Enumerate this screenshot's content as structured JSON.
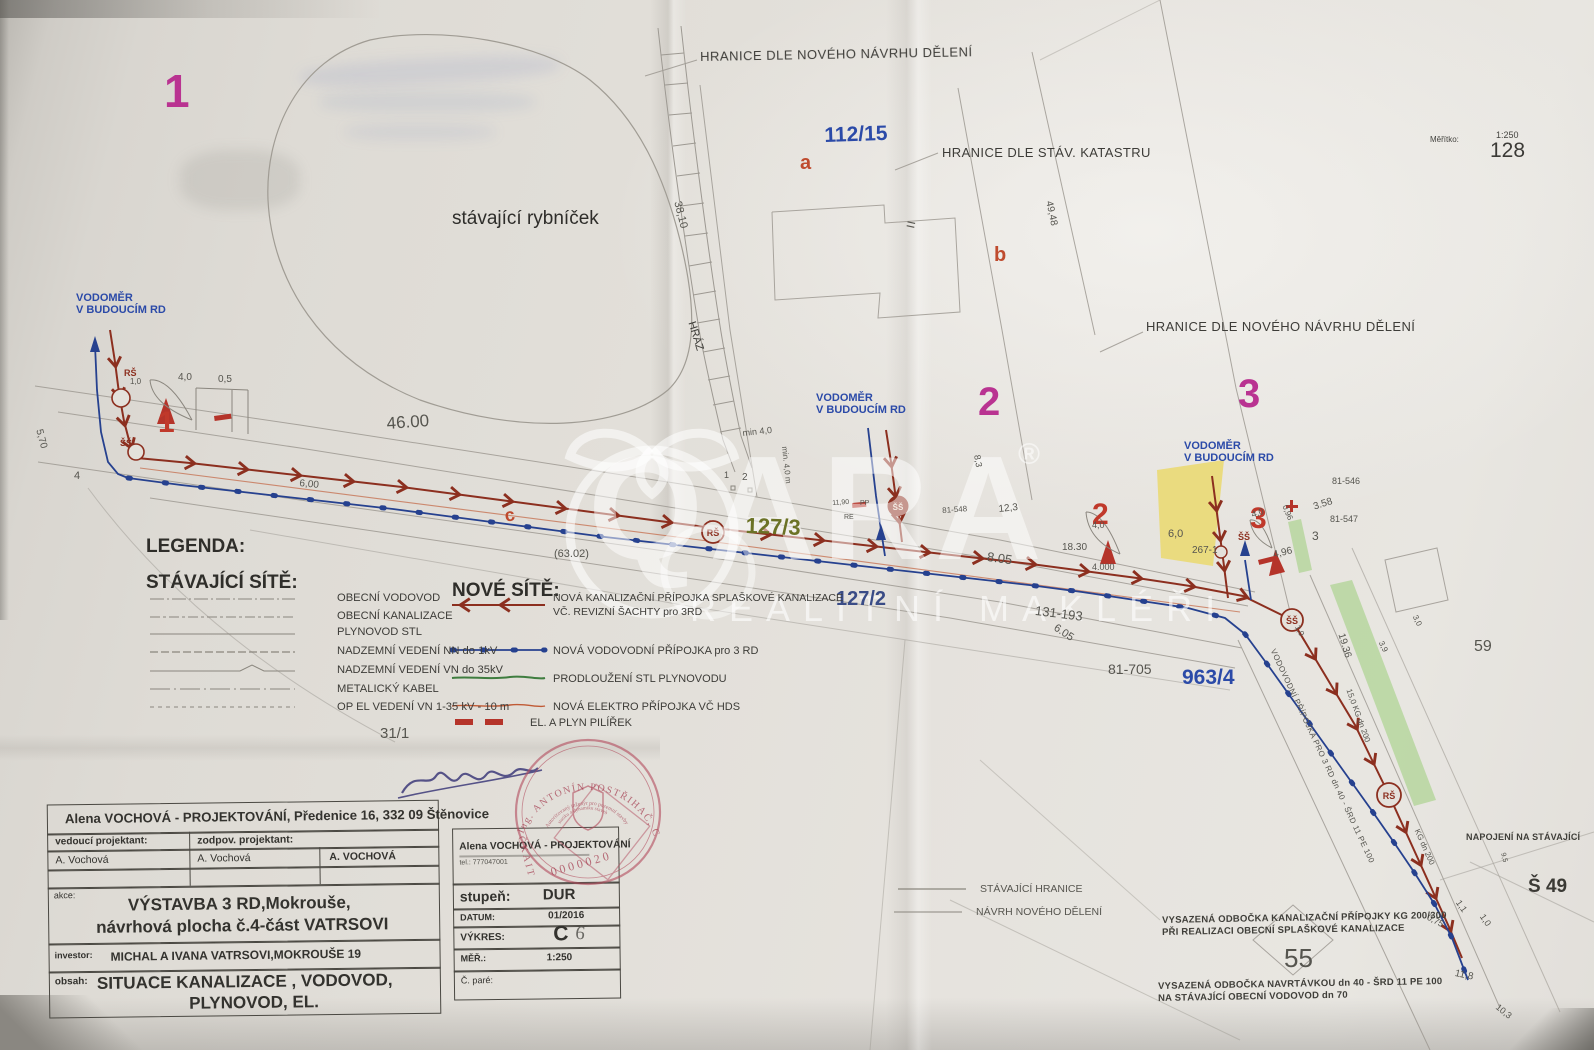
{
  "meta": {
    "scale_label": "Měřítko:",
    "scale_value": "1:250",
    "sheet_number": "128"
  },
  "colors": {
    "kanalizace": "#8c2f1f",
    "vodovod": "#26418f",
    "plynovod": "#4f8a4a",
    "elektro": "#c05a35",
    "magenta": "#b93391",
    "yellow_parcel": "#ead974",
    "stamp_red": "#b24a5c",
    "label_blue": "#2b4aa8"
  },
  "watermark": {
    "brand": "QARA",
    "reg": "®",
    "subtitle": "REALITNÍ MAKLÉŘI"
  },
  "map": {
    "boundary_top": "HRANICE DLE NOVÉHO NÁVRHU DĚLENÍ",
    "boundary_katastr": "HRANICE DLE STÁV. KATASTRU",
    "boundary_right": "HRANICE DLE NOVÉHO NÁVRHU DĚLENÍ",
    "pond": "stávající rybníček",
    "hraz": "HRÁZ",
    "vodomer_line1": "VODOMĚR",
    "vodomer_line2": "V BUDOUCÍM RD",
    "parcel_112": "112/15",
    "parcel_127_3": "127/3",
    "parcel_127_2": "127/2",
    "parcel_963": "963/4",
    "parcel_131": "131-193",
    "parcel_81_705": "81-705",
    "parcel_81_546": "81-546",
    "parcel_81_547": "81-547",
    "parcel_81_548": "81-548",
    "parcel_31": "31/1",
    "parcel_59": "59",
    "parcel_55": "55",
    "parcel_267": "267-1",
    "parcel_s49": "Š 49",
    "plot_mag_1": "1",
    "plot_mag_2": "2",
    "plot_mag_3": "3",
    "plot_red_1": "1",
    "plot_red_2": "2",
    "plot_red_3": "3",
    "letter_a": "a",
    "letter_b": "b",
    "letter_c": "c",
    "equals": "=",
    "shaft_rs": "RŠ",
    "shaft_ss": "ŠŠ",
    "corner_1": "1",
    "corner_2": "2"
  },
  "dims": {
    "d46": "46.00",
    "d570": "5,70",
    "d4": "4",
    "d600": "6,00",
    "d3810": "38,10",
    "d4948": "49,48",
    "d6302": "(63.02)",
    "d805": "8.05",
    "d605": "6.05",
    "dmin40": "min 4,0",
    "dmin40m": "min. 4,0 m",
    "d1190": "11,90",
    "dpp": "PP",
    "dre": "RE",
    "d123": "12,3",
    "d83": "8,3",
    "d1830": "18.30",
    "d40a": "4,0",
    "d4000": "4.000",
    "d60": "6,0",
    "d40b": "4,0",
    "d096": "0,96",
    "d358": "3.58",
    "d3": "3",
    "d496": "4,96",
    "d10a": "1,0",
    "d1936": "19.36",
    "d30": "3,0",
    "d39": "3,9",
    "d075": "0,75",
    "d11": "1,1",
    "d10b": "1,0",
    "d118": "11,8",
    "d103": "10,3",
    "d95": "9,5",
    "d40c": "4,0",
    "d05": "0,5",
    "d10c": "1,0"
  },
  "notes": {
    "napojeni": "NAPOJENÍ NA STÁVAJÍCÍ",
    "vysazena1a": "VYSAZENÁ ODBOČKA  KANALIZAČNÍ PŘÍPOJKY  KG 200/300",
    "vysazena1b": "PŘI REALIZACI OBECNÍ SPLAŠKOVÉ KANALIZACE",
    "vysazena2a": "VYSAZENÁ ODBOČKA  NAVRTÁVKOU dn 40  - ŠRD 11 PE 100",
    "vysazena2b": "NA STÁVAJÍCÍ OBECNÍ VODOVOD  dn 70",
    "vodovodni_diag": "VODOVODNÍ PŘÍPOJKA PRO 3 RD  dn 40 - ŠRD 11 PE 100",
    "kg_15": "15,0  KG dn 200",
    "kg_dn200": "KG dn 200"
  },
  "legend": {
    "title": "LEGENDA:",
    "existing_title": "STÁVAJÍCÍ SÍTĚ:",
    "existing": [
      "OBECNÍ VODOVOD",
      "OBECNÍ KANALIZACE",
      "PLYNOVOD STL",
      "NADZEMNÍ VEDENÍ  NN do 1kV",
      "NADZEMNÍ VEDENÍ  VN do 35kV",
      "METALICKÝ KABEL",
      "OP EL VEDENÍ VN 1-35 kV   - 10 m"
    ],
    "new_title": "NOVÉ SÍTĚ:",
    "new_1": "NOVÁ KANALIZAČNÍ PŘÍPOJKA SPLAŠKOVÉ KANALIZACE\nVČ. REVIZNÍ  ŠACHTY  pro 3RD",
    "new_2": "NOVÁ VODOVODNÍ  PŘÍPOJKA  pro 3 RD",
    "new_3": "PRODLOUŽENÍ  STL  PLYNOVODU",
    "new_4": "NOVÁ ELEKTRO   PŘÍPOJKA VČ  HDS",
    "new_5": "EL. A PLYN PILÍŘEK",
    "boundary_existing": "STÁVAJÍCÍ  HRANICE",
    "boundary_new": "NÁVRH NOVÉHO DĚLENÍ"
  },
  "title_block": {
    "company_header": "Alena VOCHOVÁ - PROJEKTOVÁNÍ, Předenice 16, 332 09 Štěnovice",
    "role1_label": "vedoucí projektant:",
    "role2_label": "zodpov. projektant:",
    "name1": "A. Vochová",
    "name2": "A. Vochová",
    "name3": "A. VOCHOVÁ",
    "akce_label": "akce:",
    "akce_line1": "VÝSTAVBA 3 RD,Mokrouše,",
    "akce_line2": "návrhová plocha č.4-část VATRSOVI",
    "investor_label": "investor:",
    "investor_value": "MICHAL A IVANA VATRSOVI,MOKROUŠE 19",
    "obsah_label": "obsah:",
    "obsah_line1": "SITUACE  KANALIZACE , VODOVOD,",
    "obsah_line2": "PLYNOVOD, EL.",
    "firm_name": "Alena  VOCHOVÁ - PROJEKTOVÁNÍ",
    "firm_tel": "tel.: 777047001",
    "stupen_label": "stupeň:",
    "stupen_value": "DUR",
    "datum_label": "DATUM:",
    "datum_value": "01/2016",
    "vykres_label": "VÝKRES:",
    "vykres_value": "C",
    "vykres_hand": "6",
    "mer_label": "MĚŘ.:",
    "mer_value": "1:250",
    "pare_label": "Č. paré:"
  },
  "stamp": {
    "title": "Ing. ANTONÍN POSTŘIHAČ, CSc.",
    "sub1": "Autorizovaný inženýr pro pozemní stavby",
    "sub2": "statiku a dynamiku staveb",
    "org": "ČKAIT",
    "number": "0000020"
  }
}
